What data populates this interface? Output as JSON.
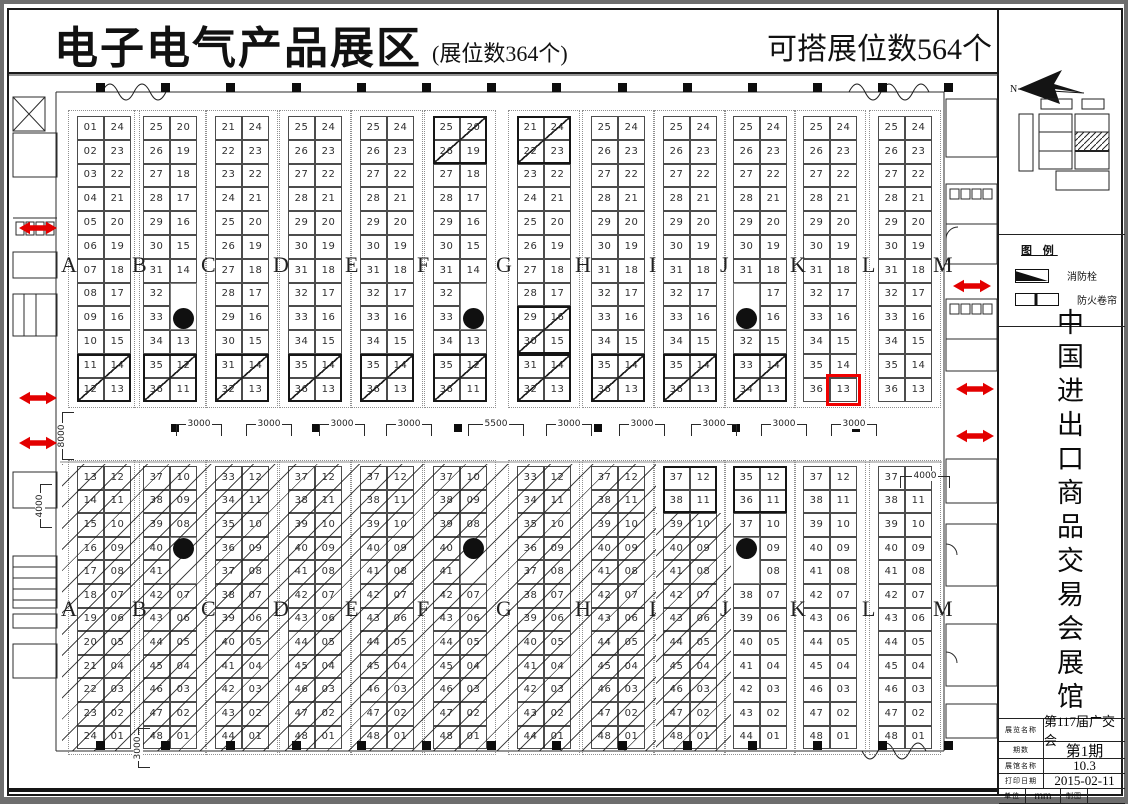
{
  "header": {
    "title": "电子电气产品展区",
    "subtitle": "(展位数364个)",
    "right_note": "可搭展位数564个"
  },
  "column_letters": [
    "A",
    "B",
    "C",
    "D",
    "E",
    "F",
    "G",
    "H",
    "I",
    "J",
    "K",
    "L",
    "M"
  ],
  "top_section": {
    "groups": [
      {
        "left": [
          "01",
          "02",
          "03",
          "04",
          "05",
          "06",
          "07",
          "08",
          "09",
          "10",
          "11",
          "12"
        ],
        "right": [
          "24",
          "23",
          "22",
          "21",
          "20",
          "19",
          "18",
          "17",
          "16",
          "15",
          "14",
          "13"
        ]
      },
      {
        "left": [
          "25",
          "26",
          "27",
          "28",
          "29",
          "30",
          "31",
          "32",
          "33",
          "34",
          "35",
          "36"
        ],
        "right": [
          "20",
          "19",
          "18",
          "17",
          "16",
          "15",
          "14",
          "",
          "P",
          "13",
          "12",
          "11"
        ]
      },
      {
        "left": [
          "21",
          "22",
          "23",
          "24",
          "25",
          "26",
          "27",
          "28",
          "29",
          "30",
          "31",
          "32"
        ],
        "right": [
          "24",
          "23",
          "22",
          "21",
          "20",
          "19",
          "18",
          "17",
          "16",
          "15",
          "14",
          "13"
        ]
      },
      {
        "left": [
          "25",
          "26",
          "27",
          "28",
          "29",
          "30",
          "31",
          "32",
          "33",
          "34",
          "35",
          "36"
        ],
        "right": [
          "24",
          "23",
          "22",
          "21",
          "20",
          "19",
          "18",
          "17",
          "16",
          "15",
          "14",
          "13"
        ]
      },
      {
        "left": [
          "25",
          "26",
          "27",
          "28",
          "29",
          "30",
          "31",
          "32",
          "33",
          "34",
          "35",
          "36"
        ],
        "right": [
          "24",
          "23",
          "22",
          "21",
          "20",
          "19",
          "18",
          "17",
          "16",
          "15",
          "14",
          "13"
        ]
      },
      {
        "left": [
          "25",
          "26",
          "27",
          "28",
          "29",
          "30",
          "31",
          "32",
          "33",
          "34",
          "35",
          "36"
        ],
        "right": [
          "20",
          "19",
          "18",
          "17",
          "16",
          "15",
          "14",
          "",
          "P",
          "13",
          "12",
          "11"
        ]
      },
      {
        "left": [
          "21",
          "22",
          "23",
          "24",
          "25",
          "26",
          "27",
          "28",
          "29",
          "30",
          "31",
          "32"
        ],
        "right": [
          "24",
          "23",
          "22",
          "21",
          "20",
          "19",
          "18",
          "17",
          "16",
          "15",
          "14",
          "13"
        ]
      },
      {
        "left": [
          "25",
          "26",
          "27",
          "28",
          "29",
          "30",
          "31",
          "32",
          "33",
          "34",
          "35",
          "36"
        ],
        "right": [
          "24",
          "23",
          "22",
          "21",
          "20",
          "19",
          "18",
          "17",
          "16",
          "15",
          "14",
          "13"
        ]
      },
      {
        "left": [
          "25",
          "26",
          "27",
          "28",
          "29",
          "30",
          "31",
          "32",
          "33",
          "34",
          "35",
          "36"
        ],
        "right": [
          "24",
          "23",
          "22",
          "21",
          "20",
          "19",
          "18",
          "17",
          "16",
          "15",
          "14",
          "13"
        ]
      },
      {
        "left": [
          "25",
          "26",
          "27",
          "28",
          "29",
          "30",
          "31",
          "",
          "P",
          "32",
          "33",
          "34"
        ],
        "right": [
          "24",
          "23",
          "22",
          "21",
          "20",
          "19",
          "18",
          "17",
          "16",
          "15",
          "14",
          "13"
        ]
      },
      {
        "left": [
          "25",
          "26",
          "27",
          "28",
          "29",
          "30",
          "31",
          "32",
          "33",
          "34",
          "35",
          "36"
        ],
        "right": [
          "24",
          "23",
          "22",
          "21",
          "20",
          "19",
          "18",
          "17",
          "16",
          "15",
          "14",
          "13"
        ]
      },
      {
        "left": [
          "25",
          "26",
          "27",
          "28",
          "29",
          "30",
          "31",
          "32",
          "33",
          "34",
          "35",
          "36"
        ],
        "right": [
          "24",
          "23",
          "22",
          "21",
          "20",
          "19",
          "18",
          "17",
          "16",
          "15",
          "14",
          "13"
        ]
      }
    ],
    "diagonal_blocks": [
      {
        "g": 0,
        "row": 11
      },
      {
        "g": 1,
        "row": 11
      },
      {
        "g": 2,
        "row": 11
      },
      {
        "g": 3,
        "row": 11
      },
      {
        "g": 4,
        "row": 11
      },
      {
        "g": 5,
        "row": 1
      },
      {
        "g": 5,
        "row": 11
      },
      {
        "g": 6,
        "row": 1
      },
      {
        "g": 6,
        "row": 9
      },
      {
        "g": 6,
        "row": 11
      },
      {
        "g": 7,
        "row": 11
      },
      {
        "g": 8,
        "row": 11
      },
      {
        "g": 9,
        "row": 11
      }
    ]
  },
  "bottom_section": {
    "groups": [
      {
        "left": [
          "13",
          "14",
          "15",
          "16",
          "17",
          "18",
          "19",
          "20",
          "21",
          "22",
          "23",
          "24"
        ],
        "right": [
          "12",
          "11",
          "10",
          "09",
          "08",
          "07",
          "06",
          "05",
          "04",
          "03",
          "02",
          "01"
        ]
      },
      {
        "left": [
          "37",
          "38",
          "39",
          "40",
          "41",
          "42",
          "43",
          "44",
          "45",
          "46",
          "47",
          "48"
        ],
        "right": [
          "10",
          "09",
          "08",
          "P",
          "",
          "07",
          "06",
          "05",
          "04",
          "03",
          "02",
          "01"
        ]
      },
      {
        "left": [
          "33",
          "34",
          "35",
          "36",
          "37",
          "38",
          "39",
          "40",
          "41",
          "42",
          "43",
          "44"
        ],
        "right": [
          "12",
          "11",
          "10",
          "09",
          "08",
          "07",
          "06",
          "05",
          "04",
          "03",
          "02",
          "01"
        ]
      },
      {
        "left": [
          "37",
          "38",
          "39",
          "40",
          "41",
          "42",
          "43",
          "44",
          "45",
          "46",
          "47",
          "48"
        ],
        "right": [
          "12",
          "11",
          "10",
          "09",
          "08",
          "07",
          "06",
          "05",
          "04",
          "03",
          "02",
          "01"
        ]
      },
      {
        "left": [
          "37",
          "38",
          "39",
          "40",
          "41",
          "42",
          "43",
          "44",
          "45",
          "46",
          "47",
          "48"
        ],
        "right": [
          "12",
          "11",
          "10",
          "09",
          "08",
          "07",
          "06",
          "05",
          "04",
          "03",
          "02",
          "01"
        ]
      },
      {
        "left": [
          "37",
          "38",
          "39",
          "40",
          "41",
          "42",
          "43",
          "44",
          "45",
          "46",
          "47",
          "48"
        ],
        "right": [
          "10",
          "09",
          "08",
          "P",
          "",
          "07",
          "06",
          "05",
          "04",
          "03",
          "02",
          "01"
        ]
      },
      {
        "left": [
          "33",
          "34",
          "35",
          "36",
          "37",
          "38",
          "39",
          "40",
          "41",
          "42",
          "43",
          "44"
        ],
        "right": [
          "12",
          "11",
          "10",
          "09",
          "08",
          "07",
          "06",
          "05",
          "04",
          "03",
          "02",
          "01"
        ]
      },
      {
        "left": [
          "37",
          "38",
          "39",
          "40",
          "41",
          "42",
          "43",
          "44",
          "45",
          "46",
          "47",
          "48"
        ],
        "right": [
          "12",
          "11",
          "10",
          "09",
          "08",
          "07",
          "06",
          "05",
          "04",
          "03",
          "02",
          "01"
        ]
      },
      {
        "left": [
          "37",
          "38",
          "39",
          "40",
          "41",
          "42",
          "43",
          "44",
          "45",
          "46",
          "47",
          "48"
        ],
        "right": [
          "12",
          "11",
          "10",
          "09",
          "08",
          "07",
          "06",
          "05",
          "04",
          "03",
          "02",
          "01"
        ]
      },
      {
        "left": [
          "35",
          "36",
          "37",
          "P",
          "",
          "38",
          "39",
          "40",
          "41",
          "42",
          "43",
          "44"
        ],
        "right": [
          "12",
          "11",
          "10",
          "09",
          "08",
          "07",
          "06",
          "05",
          "04",
          "03",
          "02",
          "01"
        ]
      },
      {
        "left": [
          "37",
          "38",
          "39",
          "40",
          "41",
          "42",
          "43",
          "44",
          "45",
          "46",
          "47",
          "48"
        ],
        "right": [
          "12",
          "11",
          "10",
          "09",
          "08",
          "07",
          "06",
          "05",
          "04",
          "03",
          "02",
          "01"
        ]
      },
      {
        "left": [
          "37",
          "38",
          "39",
          "40",
          "41",
          "42",
          "43",
          "44",
          "45",
          "46",
          "47",
          "48"
        ],
        "right": [
          "12",
          "11",
          "10",
          "09",
          "08",
          "07",
          "06",
          "05",
          "04",
          "03",
          "02",
          "01"
        ]
      }
    ],
    "bold_blocks": [
      {
        "g": 8,
        "row": 1
      },
      {
        "g": 9,
        "row": 1
      }
    ]
  },
  "highlight": {
    "section": "top",
    "group": 10,
    "side": "right",
    "row": 12,
    "color": "#f00000"
  },
  "dimensions": [
    {
      "label": "3000",
      "x": 172,
      "y": 420,
      "o": "h",
      "w": 46
    },
    {
      "label": "3000",
      "x": 242,
      "y": 420,
      "o": "h",
      "w": 46
    },
    {
      "label": "3000",
      "x": 315,
      "y": 420,
      "o": "h",
      "w": 46
    },
    {
      "label": "3000",
      "x": 382,
      "y": 420,
      "o": "h",
      "w": 46
    },
    {
      "label": "5500",
      "x": 464,
      "y": 420,
      "o": "h",
      "w": 56
    },
    {
      "label": "3000",
      "x": 542,
      "y": 420,
      "o": "h",
      "w": 46
    },
    {
      "label": "3000",
      "x": 615,
      "y": 420,
      "o": "h",
      "w": 46
    },
    {
      "label": "3000",
      "x": 687,
      "y": 420,
      "o": "h",
      "w": 46
    },
    {
      "label": "3000",
      "x": 757,
      "y": 420,
      "o": "h",
      "w": 46
    },
    {
      "label": "3000",
      "x": 827,
      "y": 420,
      "o": "h",
      "w": 46
    },
    {
      "label": "4000",
      "x": 896,
      "y": 472,
      "o": "h",
      "w": 50
    },
    {
      "label": "8000",
      "x": 58,
      "y": 456,
      "o": "v",
      "w": 48
    },
    {
      "label": "4000",
      "x": 36,
      "y": 524,
      "o": "v",
      "w": 44
    },
    {
      "label": "3000",
      "x": 134,
      "y": 764,
      "o": "v",
      "w": 40
    }
  ],
  "exit_arrows": [
    {
      "x": 14,
      "y": 216
    },
    {
      "x": 14,
      "y": 386
    },
    {
      "x": 14,
      "y": 431
    },
    {
      "x": 948,
      "y": 274
    },
    {
      "x": 951,
      "y": 377
    },
    {
      "x": 951,
      "y": 424
    }
  ],
  "north": {
    "label": "N"
  },
  "legend": {
    "title": "图 例",
    "items": [
      {
        "icon": "fire-hydrant-icon",
        "label": "消防栓"
      },
      {
        "icon": "fire-shutter-icon",
        "label": "防火卷帘"
      }
    ]
  },
  "sidebar": {
    "title": "中国进出口商品交易会展馆"
  },
  "title_block": {
    "rows": [
      {
        "label": "展览名称",
        "value": "第117届广交会"
      },
      {
        "label": "期数",
        "value": "第1期"
      },
      {
        "label": "展馆名称",
        "value": "10.3"
      },
      {
        "label": "打印日期",
        "value": "2015-02-11"
      }
    ],
    "footer": {
      "unit_label": "单位",
      "unit_value": "mm",
      "draft_label": "制图",
      "draft_value": ""
    }
  }
}
